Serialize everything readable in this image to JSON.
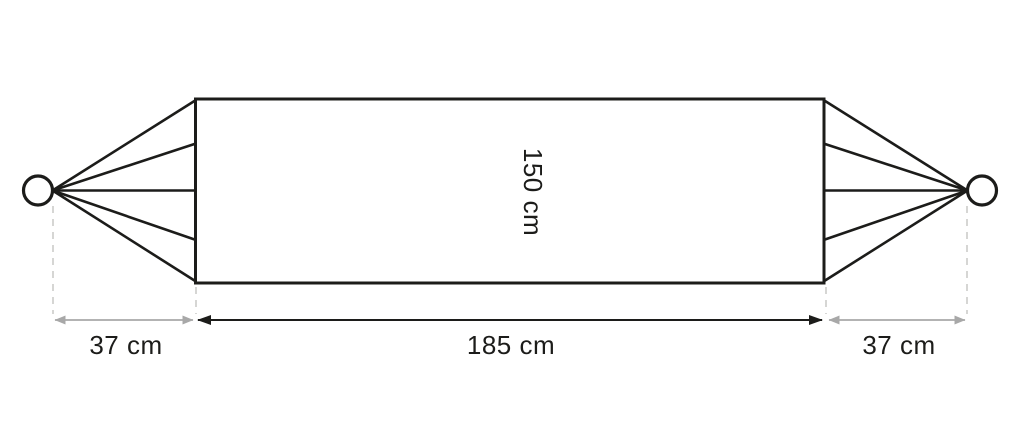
{
  "diagram": {
    "name": "Hammock dimensions diagram",
    "dimensions": {
      "bed_width_label": "150 cm",
      "bed_length_label": "185 cm",
      "left_suspension_label": "37 cm",
      "right_suspension_label": "37 cm"
    },
    "values": {
      "bed_width_cm": 150,
      "bed_length_cm": 185,
      "left_suspension_cm": 37,
      "right_suspension_cm": 37
    },
    "colors": {
      "outline": "#1c1c1a",
      "dimension_black": "#1c1c1a",
      "dimension_gray": "#a8a8a8",
      "dashed_guide": "#d2d2d0",
      "label_text": "#1c1c1a",
      "background": "#ffffff"
    }
  }
}
